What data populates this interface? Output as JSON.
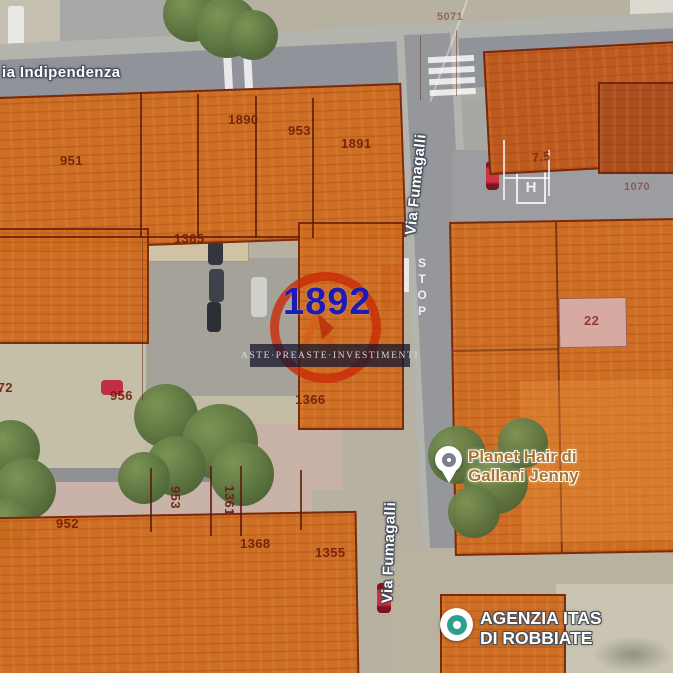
{
  "streets": {
    "indipendenza": "ia Indipendenza",
    "fumagalli_top": "Via Fumagalli",
    "fumagalli_bottom": "Via Fumagalli"
  },
  "road_markings": {
    "stop": "STOP",
    "bus_h": "H"
  },
  "parcel_labels": {
    "n951": "951",
    "n1890": "1890",
    "n953_top": "953",
    "n1891": "1891",
    "n1365": "1365",
    "n1366": "1366",
    "n972": "972",
    "n956": "956",
    "n952": "952",
    "n953_bottom": "953",
    "n1361": "1361",
    "n1368": "1368",
    "n1355": "1355",
    "n22": "22",
    "n7_5": "7.5",
    "n5071": "5071",
    "n1070": "1070"
  },
  "watermark": {
    "lot_number": "1892",
    "brand": "ASTE·PREASTE·INVESTIMENTI"
  },
  "pois": {
    "planet_hair": {
      "line1": "Planet Hair di",
      "line2": "Gallani Jenny"
    },
    "agenzia_itas": {
      "line1": "AGENZIA ITAS",
      "line2": "DI ROBBIATE"
    }
  },
  "colors": {
    "parcel_fill": "#cf6a1e",
    "parcel_border": "#6e2008",
    "lot_number_blue": "#1c1cb4",
    "watermark_red": "#c92b07",
    "poi_planet_text": "#a8762e",
    "poi_itas_text": "#ffffff"
  }
}
